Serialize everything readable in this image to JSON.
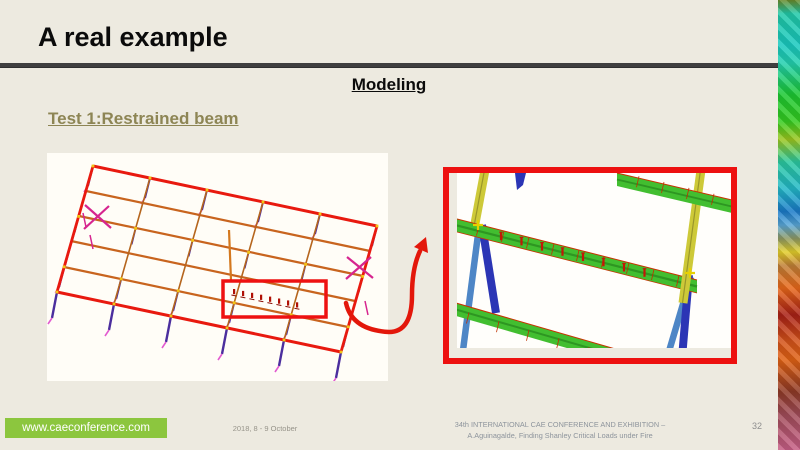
{
  "slide": {
    "title": "A real example",
    "subtitle": "Modeling",
    "section_label": "Test 1:Restrained beam",
    "page_number": "32"
  },
  "footer": {
    "website": "www.caeconference.com",
    "date": "2018, 8 - 9 October",
    "conference_line1": "34th INTERNATIONAL CAE CONFERENCE AND EXHIBITION –",
    "conference_line2": "A.Aguinagalde, Finding Shanley Critical Loads under Fire"
  },
  "icons": {
    "callout_arrow": "curved-red-arrow",
    "art_strip": "color-mosaic-strip"
  },
  "colors": {
    "background": "#EDEAE0",
    "accent_red": "#ED1110",
    "badge_green": "#8CC63E",
    "section_olive": "#8D8554",
    "rule_gray": "#3F3F3F"
  }
}
